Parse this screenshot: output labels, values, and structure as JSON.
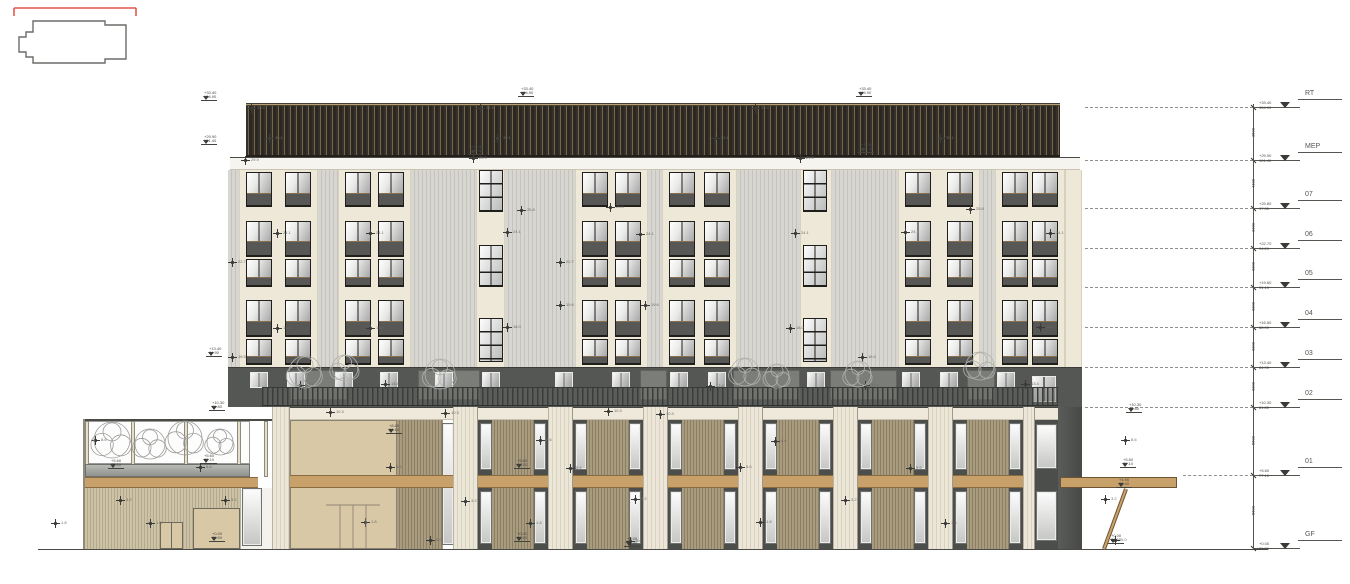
{
  "colors": {
    "accent_red": "#e2574c",
    "outline": "#6b6b68",
    "cream_panel": "#eee8d8",
    "rib_panel": "#d8d6d1",
    "window_frame": "#1f1e1b",
    "band_gray": "#555754",
    "slat_tan": "#a89b7e",
    "wood_band": "#c7a06a",
    "beige_wall": "#d8c8a6",
    "ground": "#4a4a48"
  },
  "keyplan": {
    "red_bracket": "M6,6 L128,6 M6,6 L6,14 M128,6 L128,14",
    "outline": "M25,19 L97,19 L97,23 L118,23 L118,57 L97,57 L97,61 L25,61 L25,55 L18,55 L18,50 L11,50 L11,35 L18,35 L18,30 L25,30 Z"
  },
  "ground": {
    "x1": 38,
    "x2": 1268,
    "y": 549
  },
  "levels": [
    {
      "label": "RT",
      "y": 107,
      "rel": "+33.40",
      "abs": "104.90"
    },
    {
      "label": "MEP",
      "y": 160,
      "rel": "+29.90",
      "abs": "101.40"
    },
    {
      "label": "07",
      "y": 208,
      "rel": "+25.80",
      "abs": "97.30"
    },
    {
      "label": "06",
      "y": 248,
      "rel": "+22.70",
      "abs": "94.20"
    },
    {
      "label": "05",
      "y": 287,
      "rel": "+19.60",
      "abs": "91.10"
    },
    {
      "label": "04",
      "y": 327,
      "rel": "+16.50",
      "abs": "88.00"
    },
    {
      "label": "03",
      "y": 367,
      "rel": "+13.40",
      "abs": "84.90"
    },
    {
      "label": "02",
      "y": 407,
      "rel": "+10.30",
      "abs": "81.80"
    },
    {
      "label": "01",
      "y": 475,
      "rel": "+5.60",
      "abs": "77.10"
    },
    {
      "label": "GF",
      "y": 548,
      "rel": "+0.00",
      "abs": "71.50"
    }
  ],
  "dims": [
    {
      "y": 133,
      "v": "3500"
    },
    {
      "y": 184,
      "v": "4100"
    },
    {
      "y": 228,
      "v": "3300"
    },
    {
      "y": 267,
      "v": "3300"
    },
    {
      "y": 307,
      "v": "3300"
    },
    {
      "y": 347,
      "v": "3300"
    },
    {
      "y": 387,
      "v": "3300"
    },
    {
      "y": 441,
      "v": "5600"
    },
    {
      "y": 511,
      "v": "5600"
    }
  ],
  "dim_line": {
    "x": 1253,
    "y1": 104,
    "y2": 549
  },
  "dashed": [
    {
      "y": 107,
      "x1": 1085,
      "x2": 1253
    },
    {
      "y": 160,
      "x1": 1085,
      "x2": 1253
    },
    {
      "y": 208,
      "x1": 1085,
      "x2": 1253
    },
    {
      "y": 248,
      "x1": 1085,
      "x2": 1253
    },
    {
      "y": 287,
      "x1": 1085,
      "x2": 1253
    },
    {
      "y": 327,
      "x1": 1085,
      "x2": 1253
    },
    {
      "y": 367,
      "x1": 1085,
      "x2": 1253
    },
    {
      "y": 407,
      "x1": 1085,
      "x2": 1253
    },
    {
      "y": 475,
      "x1": 1183,
      "x2": 1253
    }
  ],
  "tower": {
    "x": 228,
    "w": 854,
    "roof": {
      "x": 246,
      "w": 814,
      "y": 103,
      "h": 54
    },
    "parapet": {
      "x": 230,
      "w": 850,
      "y": 157,
      "h": 13
    },
    "facade": {
      "y": 170,
      "h": 197
    },
    "bays": [
      {
        "t": "rib",
        "x": 228,
        "w": 11
      },
      {
        "t": "win2",
        "x": 239,
        "w": 79
      },
      {
        "t": "rib",
        "x": 318,
        "w": 20
      },
      {
        "t": "win2",
        "x": 338,
        "w": 73
      },
      {
        "t": "rib",
        "x": 411,
        "w": 65
      },
      {
        "t": "stair",
        "x": 476,
        "w": 29
      },
      {
        "t": "rib",
        "x": 505,
        "w": 70
      },
      {
        "t": "win2",
        "x": 575,
        "w": 73
      },
      {
        "t": "rib",
        "x": 648,
        "w": 14
      },
      {
        "t": "win2",
        "x": 662,
        "w": 75
      },
      {
        "t": "rib",
        "x": 737,
        "w": 63
      },
      {
        "t": "stair",
        "x": 800,
        "w": 32
      },
      {
        "t": "rib",
        "x": 832,
        "w": 66
      },
      {
        "t": "win2",
        "x": 898,
        "w": 82
      },
      {
        "t": "rib",
        "x": 980,
        "w": 15
      },
      {
        "t": "win2",
        "x": 995,
        "w": 70
      },
      {
        "t": "edge",
        "x": 1065,
        "w": 17
      }
    ],
    "rows": [
      {
        "y": 172,
        "h": 35,
        "g": 20
      },
      {
        "y": 221,
        "h": 36,
        "g": 19
      },
      {
        "y": 259,
        "h": 28,
        "g": 17
      },
      {
        "y": 300,
        "h": 37,
        "g": 20
      },
      {
        "y": 339,
        "h": 26,
        "g": 16
      }
    ],
    "stair_rows": [
      {
        "y": 170,
        "h": 42
      },
      {
        "y": 245,
        "h": 42
      },
      {
        "y": 318,
        "h": 44
      }
    ]
  },
  "band": {
    "x": 228,
    "w": 854,
    "y": 367,
    "h": 40,
    "panels": [
      {
        "x": 290,
        "w": 57
      },
      {
        "x": 418,
        "w": 62
      },
      {
        "x": 640,
        "w": 27
      },
      {
        "x": 733,
        "w": 67
      },
      {
        "x": 830,
        "w": 67
      },
      {
        "x": 967,
        "w": 28
      }
    ],
    "windows": [
      250,
      287,
      335,
      380,
      435,
      482,
      555,
      612,
      670,
      708,
      807,
      902,
      940,
      997
    ],
    "big_window": {
      "x": 1032,
      "y": 376,
      "w": 24,
      "h": 26
    },
    "rail": {
      "x": 262,
      "w": 796,
      "y": 387,
      "h": 19
    },
    "trees": [
      {
        "x": 305,
        "y": 372,
        "r": 16
      },
      {
        "x": 345,
        "y": 368,
        "r": 13
      },
      {
        "x": 440,
        "y": 374,
        "r": 15
      },
      {
        "x": 745,
        "y": 372,
        "r": 14
      },
      {
        "x": 777,
        "y": 376,
        "r": 12
      },
      {
        "x": 858,
        "y": 374,
        "r": 13
      },
      {
        "x": 980,
        "y": 366,
        "r": 14
      }
    ]
  },
  "podium": {
    "beam": {
      "x": 272,
      "w": 786,
      "y": 407,
      "h": 13
    },
    "pilasters": [
      {
        "x": 272,
        "w": 18
      },
      {
        "x": 453,
        "w": 25
      },
      {
        "x": 548,
        "w": 25
      },
      {
        "x": 643,
        "w": 25
      },
      {
        "x": 738,
        "w": 25
      },
      {
        "x": 833,
        "w": 25
      },
      {
        "x": 928,
        "w": 25
      },
      {
        "x": 1023,
        "w": 12
      }
    ],
    "bays": [
      478,
      573,
      668,
      763,
      858,
      953
    ],
    "bay_w": 70,
    "upper": {
      "y": 420,
      "h": 55
    },
    "lower": {
      "y": 488,
      "h": 61
    },
    "wood_band": {
      "x": 272,
      "w": 788,
      "y": 475,
      "h": 13
    },
    "lobby": {
      "wall": {
        "x": 290,
        "w": 107
      },
      "slat": {
        "x": 397,
        "w": 46
      },
      "win": {
        "x": 443,
        "w": 10
      },
      "door_lines": [
        [
          326,
          505,
          380,
          505
        ],
        [
          340,
          505,
          340,
          548
        ],
        [
          353,
          505,
          353,
          548
        ],
        [
          366,
          505,
          366,
          548
        ]
      ]
    },
    "right_windows": {
      "x": 1035,
      "w": 23
    },
    "right_wall": {
      "x": 1058,
      "w": 24,
      "y": 407
    }
  },
  "canopy": {
    "slab": {
      "x": 1060,
      "w": 117,
      "y": 477,
      "h": 11
    },
    "strut": [
      1126,
      489,
      1104,
      549
    ]
  },
  "wing": {
    "x": 85,
    "w": 187,
    "rail_y": 419,
    "glass": {
      "y": 421,
      "h": 43
    },
    "posts": [
      85,
      131,
      184,
      237,
      264
    ],
    "planter": {
      "y": 464,
      "h": 13
    },
    "band": {
      "y": 477,
      "h": 11
    },
    "base": {
      "y": 488,
      "h": 61
    },
    "door": {
      "x": 160,
      "w": 23,
      "y": 522,
      "h": 27
    },
    "garage": {
      "x": 193,
      "w": 47,
      "y": 508,
      "h": 41
    },
    "wall": {
      "x": 240,
      "w": 32
    },
    "win": {
      "x": 243,
      "w": 18,
      "y": 489,
      "h": 56
    },
    "trees": [
      {
        "x": 112,
        "y": 440,
        "r": 18
      },
      {
        "x": 150,
        "y": 444,
        "r": 15
      },
      {
        "x": 185,
        "y": 438,
        "r": 17
      },
      {
        "x": 220,
        "y": 442,
        "r": 13
      }
    ]
  },
  "flags": [
    {
      "x": 520,
      "y": 96,
      "a": "+33.40",
      "b": "104.90"
    },
    {
      "x": 858,
      "y": 96,
      "a": "+33.40",
      "b": "104.90"
    },
    {
      "x": 203,
      "y": 100,
      "a": "+33.40",
      "b": "104.90"
    },
    {
      "x": 203,
      "y": 144,
      "a": "+29.90",
      "b": "101.40"
    },
    {
      "x": 470,
      "y": 154,
      "a": "+32.80",
      "b": "104.30"
    },
    {
      "x": 860,
      "y": 152,
      "a": "+32.80",
      "b": "104.30"
    },
    {
      "x": 208,
      "y": 356,
      "a": "+13.40",
      "b": "84.90"
    },
    {
      "x": 211,
      "y": 410,
      "a": "+10.30",
      "b": "81.80"
    },
    {
      "x": 203,
      "y": 463,
      "a": "+5.60",
      "b": "77.10"
    },
    {
      "x": 110,
      "y": 468,
      "a": "+5.60",
      "b": "77.10"
    },
    {
      "x": 211,
      "y": 541,
      "a": "+0.00",
      "b": "71.50"
    },
    {
      "x": 516,
      "y": 468,
      "a": "+5.60",
      "b": "77.10"
    },
    {
      "x": 516,
      "y": 541,
      "a": "+0.00",
      "b": "71.50"
    },
    {
      "x": 626,
      "y": 546,
      "a": "+0.00",
      "b": "71.50"
    },
    {
      "x": 1122,
      "y": 467,
      "a": "+5.60",
      "b": "77.10"
    },
    {
      "x": 1118,
      "y": 487,
      "a": "+4.90",
      "b": "76.40"
    },
    {
      "x": 1110,
      "y": 543,
      "a": "+0.00",
      "b": "71.50"
    },
    {
      "x": 388,
      "y": 433,
      "a": "+8.60",
      "b": "80.10"
    },
    {
      "x": 1128,
      "y": 412,
      "a": "+10.30",
      "b": "81.80"
    }
  ],
  "spot_markers": [
    {
      "x": 251,
      "y": 108,
      "t": "33.4"
    },
    {
      "x": 480,
      "y": 108,
      "t": "33.4"
    },
    {
      "x": 755,
      "y": 108,
      "t": "33.4"
    },
    {
      "x": 1020,
      "y": 108,
      "t": "33.4"
    },
    {
      "x": 269,
      "y": 138,
      "t": "30.1"
    },
    {
      "x": 497,
      "y": 138,
      "t": "30.1"
    },
    {
      "x": 715,
      "y": 138,
      "t": "30.1"
    },
    {
      "x": 940,
      "y": 138,
      "t": "30.1"
    },
    {
      "x": 245,
      "y": 160,
      "t": "29.9"
    },
    {
      "x": 473,
      "y": 158,
      "t": "29.9"
    },
    {
      "x": 800,
      "y": 158,
      "t": "29.9"
    },
    {
      "x": 521,
      "y": 210,
      "t": "25.8"
    },
    {
      "x": 610,
      "y": 207,
      "t": "25.8"
    },
    {
      "x": 970,
      "y": 209,
      "t": "25.8"
    },
    {
      "x": 277,
      "y": 233,
      "t": "24.1"
    },
    {
      "x": 370,
      "y": 233,
      "t": "24.1"
    },
    {
      "x": 507,
      "y": 232,
      "t": "24.1"
    },
    {
      "x": 640,
      "y": 234,
      "t": "24.1"
    },
    {
      "x": 795,
      "y": 233,
      "t": "24.1"
    },
    {
      "x": 905,
      "y": 232,
      "t": "24.1"
    },
    {
      "x": 1050,
      "y": 233,
      "t": "24.1"
    },
    {
      "x": 232,
      "y": 262,
      "t": "22.7"
    },
    {
      "x": 560,
      "y": 262,
      "t": "22.7"
    },
    {
      "x": 560,
      "y": 305,
      "t": "19.6"
    },
    {
      "x": 645,
      "y": 305,
      "t": "19.6"
    },
    {
      "x": 277,
      "y": 328,
      "t": "18.0"
    },
    {
      "x": 370,
      "y": 328,
      "t": "18.0"
    },
    {
      "x": 507,
      "y": 327,
      "t": "18.0"
    },
    {
      "x": 790,
      "y": 328,
      "t": "18.0"
    },
    {
      "x": 1040,
      "y": 327,
      "t": "18.0"
    },
    {
      "x": 232,
      "y": 357,
      "t": "16.5"
    },
    {
      "x": 862,
      "y": 357,
      "t": "16.5"
    },
    {
      "x": 300,
      "y": 385,
      "t": "13.4"
    },
    {
      "x": 385,
      "y": 384,
      "t": "13.4"
    },
    {
      "x": 710,
      "y": 386,
      "t": "13.4"
    },
    {
      "x": 865,
      "y": 385,
      "t": "13.4"
    },
    {
      "x": 1025,
      "y": 384,
      "t": "13.4"
    },
    {
      "x": 330,
      "y": 412,
      "t": "10.3"
    },
    {
      "x": 445,
      "y": 413,
      "t": "10.3"
    },
    {
      "x": 608,
      "y": 411,
      "t": "10.3"
    },
    {
      "x": 660,
      "y": 414,
      "t": "10.3"
    },
    {
      "x": 95,
      "y": 440,
      "t": "8.6"
    },
    {
      "x": 540,
      "y": 440,
      "t": "8.6"
    },
    {
      "x": 775,
      "y": 441,
      "t": "8.6"
    },
    {
      "x": 1125,
      "y": 440,
      "t": "8.6"
    },
    {
      "x": 200,
      "y": 467,
      "t": "5.6"
    },
    {
      "x": 390,
      "y": 467,
      "t": "5.6"
    },
    {
      "x": 570,
      "y": 468,
      "t": "5.6"
    },
    {
      "x": 740,
      "y": 467,
      "t": "5.6"
    },
    {
      "x": 910,
      "y": 468,
      "t": "5.6"
    },
    {
      "x": 120,
      "y": 500,
      "t": "3.2"
    },
    {
      "x": 225,
      "y": 500,
      "t": "3.2"
    },
    {
      "x": 465,
      "y": 501,
      "t": "3.2"
    },
    {
      "x": 635,
      "y": 499,
      "t": "3.2"
    },
    {
      "x": 845,
      "y": 500,
      "t": "3.2"
    },
    {
      "x": 1105,
      "y": 499,
      "t": "3.2"
    },
    {
      "x": 55,
      "y": 523,
      "t": "1.8"
    },
    {
      "x": 150,
      "y": 523,
      "t": "1.8"
    },
    {
      "x": 365,
      "y": 522,
      "t": "1.8"
    },
    {
      "x": 530,
      "y": 523,
      "t": "1.8"
    },
    {
      "x": 760,
      "y": 522,
      "t": "1.8"
    },
    {
      "x": 945,
      "y": 523,
      "t": "1.8"
    },
    {
      "x": 430,
      "y": 540,
      "t": "0.0"
    },
    {
      "x": 630,
      "y": 541,
      "t": "0.0"
    },
    {
      "x": 1115,
      "y": 540,
      "t": "0.0"
    }
  ]
}
